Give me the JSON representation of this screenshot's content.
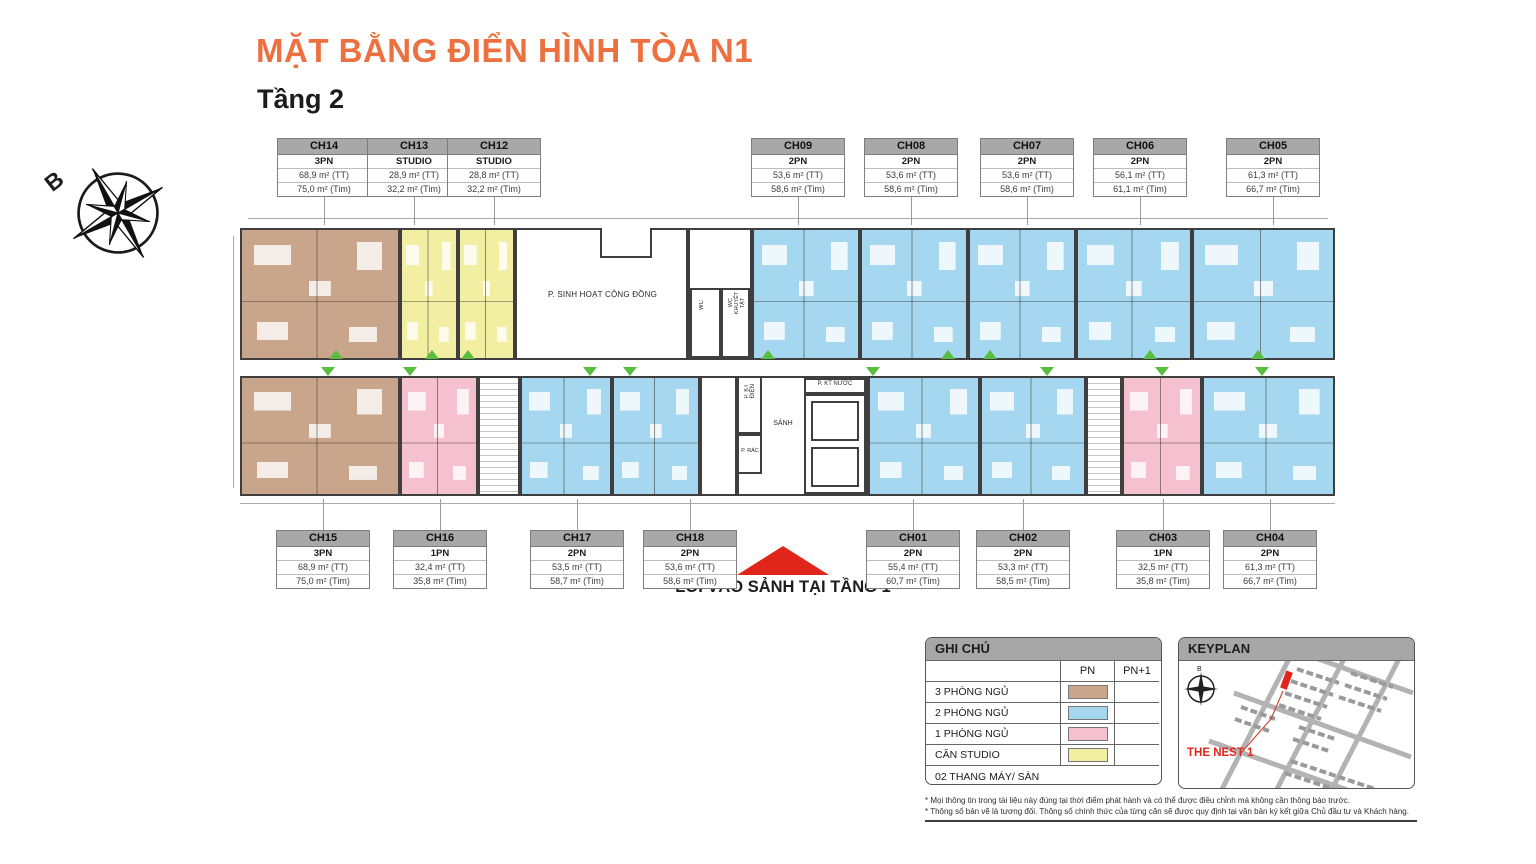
{
  "title": "MẶT BẰNG ĐIỂN HÌNH TÒA N1",
  "subtitle": "Tầng 2",
  "compass_label": "B",
  "units_top": [
    {
      "code": "CH14",
      "type": "3PN",
      "area_tt": "68,9 m² (TT)",
      "area_tim": "75,0 m² (Tim)"
    },
    {
      "code": "CH13",
      "type": "STUDIO",
      "area_tt": "28,9 m² (TT)",
      "area_tim": "32,2 m² (Tim)"
    },
    {
      "code": "CH12",
      "type": "STUDIO",
      "area_tt": "28,8 m² (TT)",
      "area_tim": "32,2 m² (Tim)"
    },
    {
      "code": "CH09",
      "type": "2PN",
      "area_tt": "53,6 m² (TT)",
      "area_tim": "58,6 m² (Tim)"
    },
    {
      "code": "CH08",
      "type": "2PN",
      "area_tt": "53,6 m² (TT)",
      "area_tim": "58,6 m² (Tim)"
    },
    {
      "code": "CH07",
      "type": "2PN",
      "area_tt": "53,6 m² (TT)",
      "area_tim": "58,6 m² (Tim)"
    },
    {
      "code": "CH06",
      "type": "2PN",
      "area_tt": "56,1 m² (TT)",
      "area_tim": "61,1 m² (Tim)"
    },
    {
      "code": "CH05",
      "type": "2PN",
      "area_tt": "61,3 m² (TT)",
      "area_tim": "66,7 m² (Tim)"
    }
  ],
  "units_bottom": [
    {
      "code": "CH15",
      "type": "3PN",
      "area_tt": "68,9 m² (TT)",
      "area_tim": "75,0 m² (Tim)"
    },
    {
      "code": "CH16",
      "type": "1PN",
      "area_tt": "32,4 m² (TT)",
      "area_tim": "35,8 m² (Tim)"
    },
    {
      "code": "CH17",
      "type": "2PN",
      "area_tt": "53,5 m² (TT)",
      "area_tim": "58,7 m² (Tim)"
    },
    {
      "code": "CH18",
      "type": "2PN",
      "area_tt": "53,6 m² (TT)",
      "area_tim": "58,6 m² (Tim)"
    },
    {
      "code": "CH01",
      "type": "2PN",
      "area_tt": "55,4 m² (TT)",
      "area_tim": "60,7 m² (Tim)"
    },
    {
      "code": "CH02",
      "type": "2PN",
      "area_tt": "53,3 m² (TT)",
      "area_tim": "58,5 m² (Tim)"
    },
    {
      "code": "CH03",
      "type": "1PN",
      "area_tt": "32,5 m² (TT)",
      "area_tim": "35,8 m² (Tim)"
    },
    {
      "code": "CH04",
      "type": "2PN",
      "area_tt": "61,3 m² (TT)",
      "area_tim": "66,7 m² (Tim)"
    }
  ],
  "plan_rooms": {
    "community": "P. SINH HOẠT CỘNG ĐỒNG",
    "wc": "WC",
    "wc_disabled": "WC KHUYẾT TẬT",
    "lobby": "SẢNH",
    "electrical": "P. KT ĐIỆN",
    "trash": "P. RÁC",
    "water": "P. KT NƯỚC"
  },
  "entrance_note": "LỐI VÀO SẢNH TẠI TẦNG 1",
  "legend": {
    "title": "GHI CHÚ",
    "col_pn": "PN",
    "col_pn1": "PN+1",
    "rows": [
      {
        "label": "3 PHÒNG NGỦ",
        "color": "#C9A58B"
      },
      {
        "label": "2 PHÒNG NGỦ",
        "color": "#A5D8F0"
      },
      {
        "label": "1 PHÒNG NGỦ",
        "color": "#F5C0D0"
      },
      {
        "label": "CĂN STUDIO",
        "color": "#F2EFA3"
      }
    ],
    "footer": "02 THANG MÁY/ SÀN"
  },
  "keyplan": {
    "title": "KEYPLAN",
    "project": "THE NEST 1",
    "compass_label": "B"
  },
  "notes": [
    "* Mọi thông tin trong tài liệu này đúng tại thời điểm phát hành và có thể được điều chỉnh mà không cần thông báo trước.",
    "* Thông số bản vẽ là tương đối. Thông số chính thức của từng căn sẽ được quy định tại văn bản ký kết giữa Chủ đầu tư và Khách hàng."
  ],
  "colors": {
    "accent_orange": "#ED7140",
    "entry_green": "#59BE3F",
    "highlight_red": "#E0261B",
    "wall": "#3F3F3F",
    "unit_3pn": "#C9A58B",
    "unit_2pn": "#A5D8F0",
    "unit_1pn": "#F5C0D0",
    "unit_studio": "#F2EFA3",
    "label_header_bg": "#A8A8A8"
  }
}
